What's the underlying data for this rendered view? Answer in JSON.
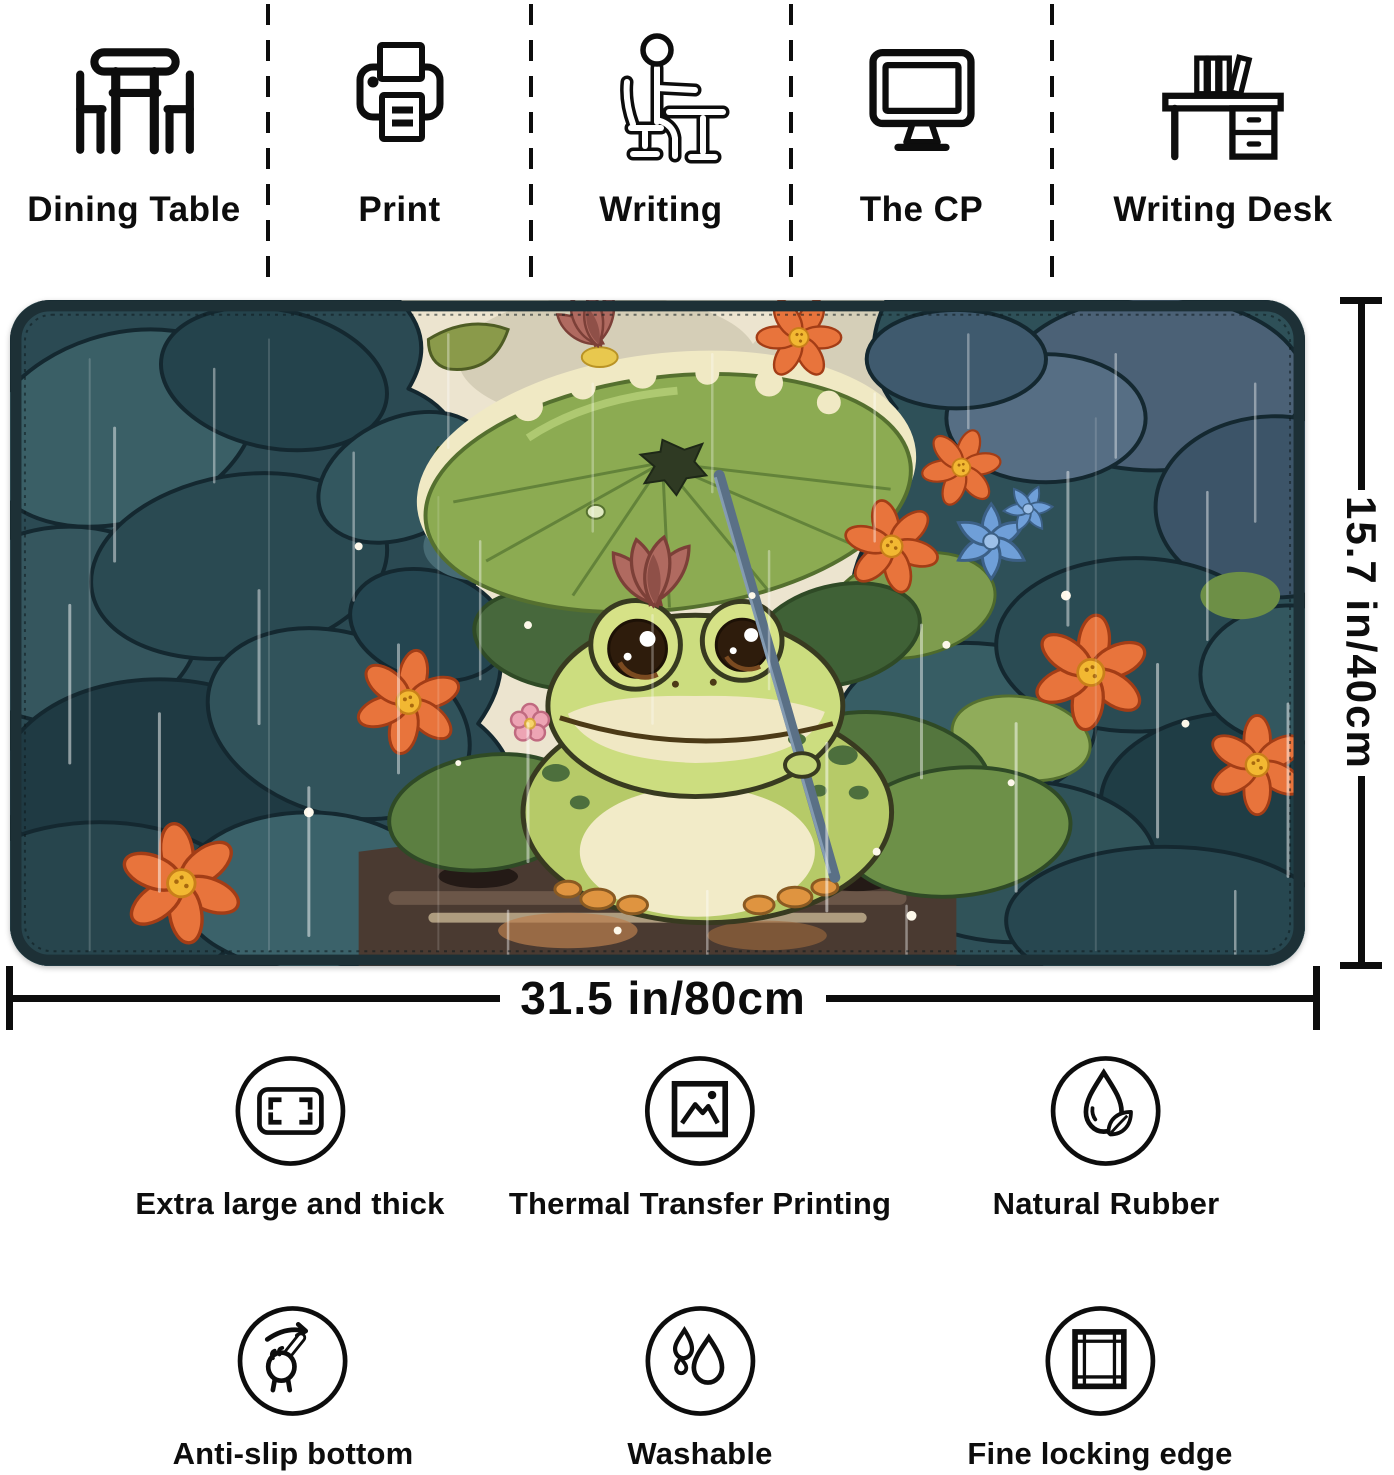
{
  "top_features": [
    {
      "icon": "dining-table-icon",
      "label": "Dining Table"
    },
    {
      "icon": "printer-icon",
      "label": "Print"
    },
    {
      "icon": "writing-person-icon",
      "label": "Writing"
    },
    {
      "icon": "computer-monitor-icon",
      "label": "The CP"
    },
    {
      "icon": "writing-desk-icon",
      "label": "Writing Desk"
    }
  ],
  "mat": {
    "width_label": "31.5 in/80cm",
    "height_label": "15.7 in/40cm",
    "artwork_description": "Frog sheltering under a lotus-leaf umbrella among rainy teal foliage with orange and blue flowers"
  },
  "bottom_features": [
    {
      "icon": "size-frame-icon",
      "label": "Extra large and thick"
    },
    {
      "icon": "picture-icon",
      "label": "Thermal Transfer Printing"
    },
    {
      "icon": "droplet-leaf-icon",
      "label": "Natural Rubber"
    },
    {
      "icon": "swipe-finger-icon",
      "label": "Anti-slip bottom"
    },
    {
      "icon": "water-drops-icon",
      "label": "Washable"
    },
    {
      "icon": "stitched-frame-icon",
      "label": "Fine locking edge"
    }
  ],
  "colors": {
    "ink": "#0d0d0d",
    "mat_border": "#1d3036",
    "foliage_teal": "#2c4d55",
    "umbrella_green": "#8cab52",
    "frog_green": "#ccdd7f",
    "flower_orange": "#e8743c",
    "flower_blue": "#6f9fd8",
    "sky_cream": "#ece4cf"
  }
}
